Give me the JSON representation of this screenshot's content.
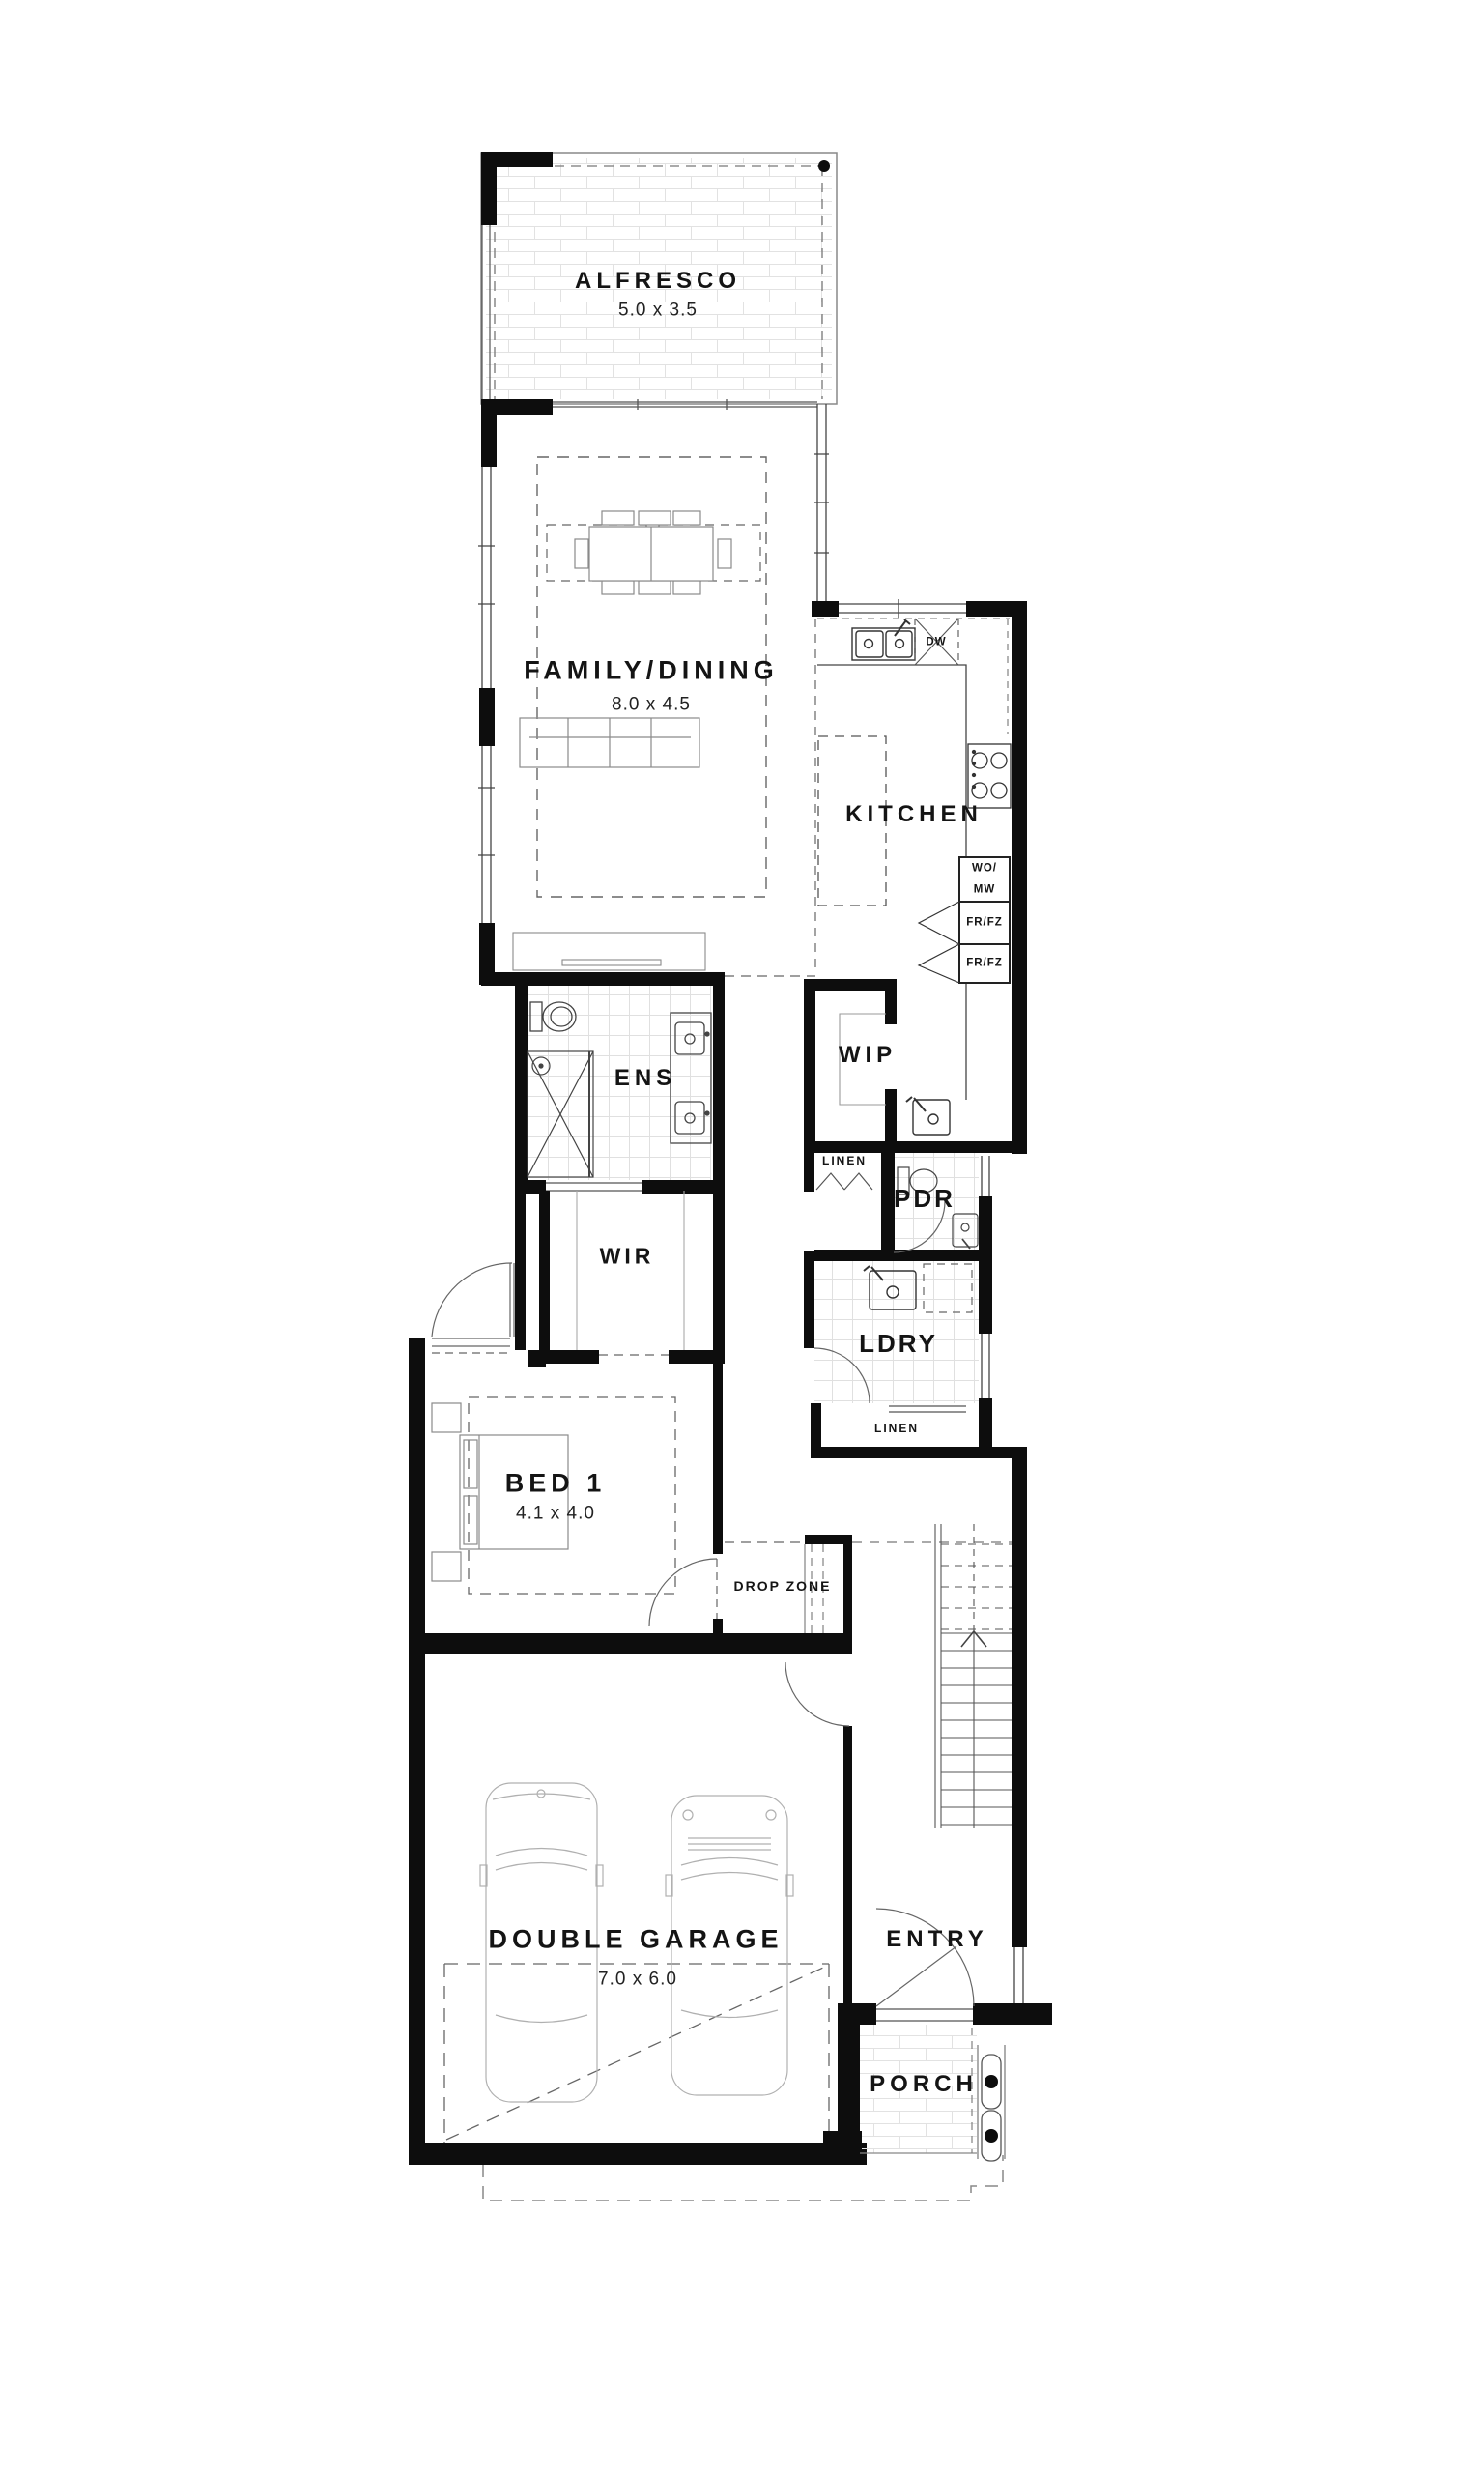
{
  "plan": {
    "rooms": {
      "alfresco": {
        "label": "ALFRESCO",
        "dims": "5.0 x 3.5"
      },
      "family_dining": {
        "label": "FAMILY/DINING",
        "dims": "8.0 x 4.5"
      },
      "kitchen": {
        "label": "KITCHEN"
      },
      "ens": {
        "label": "ENS"
      },
      "wip": {
        "label": "WIP"
      },
      "linen_upper": {
        "label": "LINEN"
      },
      "pdr": {
        "label": "PDR"
      },
      "wir": {
        "label": "WIR"
      },
      "ldry": {
        "label": "LDRY"
      },
      "linen_lower": {
        "label": "LINEN"
      },
      "bed1": {
        "label": "BED 1",
        "dims": "4.1 x 4.0"
      },
      "drop_zone": {
        "label": "DROP ZONE"
      },
      "garage": {
        "label": "DOUBLE GARAGE",
        "dims": "7.0 x 6.0"
      },
      "entry": {
        "label": "ENTRY"
      },
      "porch": {
        "label": "PORCH"
      }
    },
    "appliances": {
      "dishwasher": "DW",
      "wall_oven_microwave": [
        "WO/",
        "MW"
      ],
      "fridge_freezer_1": "FR/FZ",
      "fridge_freezer_2": "FR/FZ"
    },
    "colors": {
      "wall": "#0d0d0d",
      "line": "#444444",
      "light_line": "#999999",
      "paving_line": "#e2e2e2",
      "background": "#ffffff"
    }
  }
}
